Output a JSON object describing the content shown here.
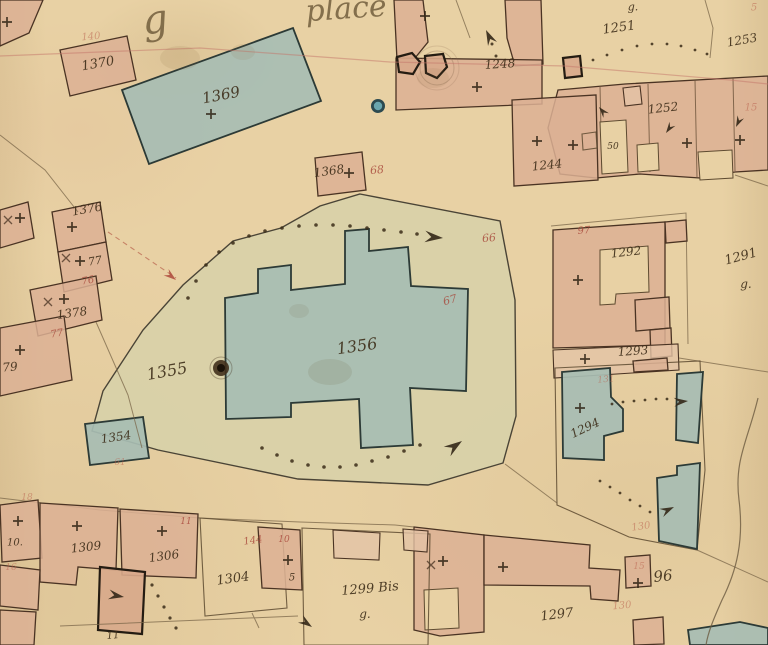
{
  "map": {
    "type": "historical-cadastral-map",
    "colors": {
      "paper": "#e8d1a4",
      "building_pink": "#dcb094",
      "building_blue": "#a7bdb3",
      "yard_green": "#d7d1a9",
      "ink": "#3a2a16",
      "red_ink": "#a8473a"
    },
    "labels": [
      {
        "n": "script-text-g",
        "t": "g",
        "x": 155,
        "y": 20,
        "s": 40,
        "r": -8,
        "c": "script"
      },
      {
        "n": "script-text-place",
        "t": "place",
        "x": 346,
        "y": 9,
        "s": 30,
        "r": -4,
        "c": "script"
      },
      {
        "n": "parcel-label-1370",
        "t": "1370",
        "x": 98,
        "y": 64,
        "s": 13,
        "r": -10,
        "c": "ink"
      },
      {
        "n": "parcel-label-1369",
        "t": "1369",
        "x": 221,
        "y": 95,
        "s": 15,
        "r": -11,
        "c": "ink"
      },
      {
        "n": "parcel-label-1368",
        "t": "1368",
        "x": 329,
        "y": 171,
        "s": 12,
        "r": -8,
        "c": "ink"
      },
      {
        "n": "parcel-label-1355",
        "t": "1355",
        "x": 167,
        "y": 371,
        "s": 16,
        "r": -10,
        "c": "ink"
      },
      {
        "n": "parcel-label-1356",
        "t": "1356",
        "x": 357,
        "y": 346,
        "s": 16,
        "r": -8,
        "c": "ink"
      },
      {
        "n": "parcel-label-1354",
        "t": "1354",
        "x": 116,
        "y": 437,
        "s": 12,
        "r": -8,
        "c": "ink"
      },
      {
        "n": "parcel-label-1376",
        "t": "1376",
        "x": 87,
        "y": 209,
        "s": 12,
        "r": -10,
        "c": "ink"
      },
      {
        "n": "parcel-label-77",
        "t": "77",
        "x": 95,
        "y": 261,
        "s": 11,
        "r": -10,
        "c": "ink"
      },
      {
        "n": "parcel-label-1378",
        "t": "1378",
        "x": 72,
        "y": 313,
        "s": 12,
        "r": -8,
        "c": "ink"
      },
      {
        "n": "parcel-label-79",
        "t": "79",
        "x": 10,
        "y": 367,
        "s": 12,
        "r": -5,
        "c": "ink"
      },
      {
        "n": "annotation-g-1251",
        "t": "g.",
        "x": 633,
        "y": 7,
        "s": 11,
        "r": 0,
        "c": "ink"
      },
      {
        "n": "parcel-label-1251",
        "t": "1251",
        "x": 619,
        "y": 28,
        "s": 13,
        "r": -8,
        "c": "ink"
      },
      {
        "n": "parcel-label-1253",
        "t": "1253",
        "x": 742,
        "y": 40,
        "s": 12,
        "r": -10,
        "c": "ink"
      },
      {
        "n": "parcel-label-1252",
        "t": "1252",
        "x": 663,
        "y": 108,
        "s": 12,
        "r": -6,
        "c": "ink"
      },
      {
        "n": "room-label-50",
        "t": "50",
        "x": 613,
        "y": 147,
        "s": 9,
        "r": 0,
        "c": "ink"
      },
      {
        "n": "parcel-label-1244",
        "t": "1244",
        "x": 547,
        "y": 165,
        "s": 12,
        "r": -6,
        "c": "ink"
      },
      {
        "n": "parcel-label-1248",
        "t": "1248",
        "x": 500,
        "y": 64,
        "s": 12,
        "r": -4,
        "c": "ink"
      },
      {
        "n": "parcel-label-1291",
        "t": "1291",
        "x": 741,
        "y": 257,
        "s": 13,
        "r": -15,
        "c": "ink"
      },
      {
        "n": "annotation-g-1291",
        "t": "g.",
        "x": 746,
        "y": 284,
        "s": 12,
        "r": 0,
        "c": "ink"
      },
      {
        "n": "parcel-label-1292",
        "t": "1292",
        "x": 626,
        "y": 252,
        "s": 12,
        "r": -6,
        "c": "ink"
      },
      {
        "n": "parcel-label-1293",
        "t": "1293",
        "x": 633,
        "y": 351,
        "s": 12,
        "r": -4,
        "c": "ink"
      },
      {
        "n": "parcel-label-1294",
        "t": "1294",
        "x": 585,
        "y": 428,
        "s": 12,
        "r": -25,
        "c": "ink"
      },
      {
        "n": "parcel-label-96",
        "t": "96",
        "x": 663,
        "y": 576,
        "s": 15,
        "r": -6,
        "c": "ink"
      },
      {
        "n": "parcel-label-1297",
        "t": "1297",
        "x": 557,
        "y": 615,
        "s": 13,
        "r": -7,
        "c": "ink"
      },
      {
        "n": "parcel-label-1299bis",
        "t": "1299 Bis",
        "x": 370,
        "y": 589,
        "s": 13,
        "r": -5,
        "c": "ink"
      },
      {
        "n": "annotation-g-1299",
        "t": "g.",
        "x": 365,
        "y": 614,
        "s": 12,
        "r": 0,
        "c": "ink"
      },
      {
        "n": "parcel-label-1304",
        "t": "1304",
        "x": 233,
        "y": 579,
        "s": 13,
        "r": -8,
        "c": "ink"
      },
      {
        "n": "parcel-label-1309",
        "t": "1309",
        "x": 86,
        "y": 547,
        "s": 12,
        "r": -6,
        "c": "ink"
      },
      {
        "n": "parcel-label-1306",
        "t": "1306",
        "x": 164,
        "y": 556,
        "s": 12,
        "r": -8,
        "c": "ink"
      },
      {
        "n": "parcel-label-10",
        "t": "10.",
        "x": 15,
        "y": 543,
        "s": 10,
        "r": 0,
        "c": "ink"
      },
      {
        "n": "parcel-label-5",
        "t": "5",
        "x": 292,
        "y": 578,
        "s": 10,
        "r": 0,
        "c": "ink"
      },
      {
        "n": "parcel-label-11",
        "t": "11",
        "x": 113,
        "y": 636,
        "s": 10,
        "r": -5,
        "c": "ink"
      },
      {
        "n": "red-ref-140",
        "t": "140",
        "x": 91,
        "y": 37,
        "s": 10,
        "r": -5,
        "c": "red-faded"
      },
      {
        "n": "red-ref-68",
        "t": "68",
        "x": 377,
        "y": 170,
        "s": 11,
        "r": -5,
        "c": "red"
      },
      {
        "n": "red-ref-66",
        "t": "66",
        "x": 489,
        "y": 238,
        "s": 11,
        "r": -5,
        "c": "red"
      },
      {
        "n": "red-ref-67",
        "t": "67",
        "x": 450,
        "y": 300,
        "s": 11,
        "r": -15,
        "c": "red"
      },
      {
        "n": "red-ref-76",
        "t": "76",
        "x": 88,
        "y": 281,
        "s": 10,
        "r": -10,
        "c": "red"
      },
      {
        "n": "red-ref-77",
        "t": "77",
        "x": 57,
        "y": 334,
        "s": 10,
        "r": -10,
        "c": "red"
      },
      {
        "n": "red-ref-97",
        "t": "97",
        "x": 584,
        "y": 231,
        "s": 10,
        "r": -5,
        "c": "red"
      },
      {
        "n": "red-ref-5",
        "t": "5",
        "x": 754,
        "y": 8,
        "s": 10,
        "r": 0,
        "c": "red-faded"
      },
      {
        "n": "red-ref-15a",
        "t": "15",
        "x": 751,
        "y": 108,
        "s": 10,
        "r": 0,
        "c": "red-faded"
      },
      {
        "n": "red-ref-11",
        "t": "11",
        "x": 186,
        "y": 522,
        "s": 9,
        "r": 0,
        "c": "red"
      },
      {
        "n": "red-ref-10",
        "t": "10",
        "x": 284,
        "y": 540,
        "s": 9,
        "r": 0,
        "c": "red"
      },
      {
        "n": "red-ref-144",
        "t": "144",
        "x": 253,
        "y": 541,
        "s": 10,
        "r": -8,
        "c": "red"
      },
      {
        "n": "red-ref-18",
        "t": "18",
        "x": 27,
        "y": 498,
        "s": 9,
        "r": 0,
        "c": "red-faded"
      },
      {
        "n": "red-ref-16",
        "t": "16",
        "x": 11,
        "y": 568,
        "s": 9,
        "r": 0,
        "c": "red-faded"
      },
      {
        "n": "red-ref-131",
        "t": "131",
        "x": 606,
        "y": 380,
        "s": 9,
        "r": -5,
        "c": "red-faded"
      },
      {
        "n": "red-ref-130a",
        "t": "130",
        "x": 641,
        "y": 527,
        "s": 10,
        "r": -8,
        "c": "red-faded"
      },
      {
        "n": "red-ref-130b",
        "t": "130",
        "x": 622,
        "y": 606,
        "s": 10,
        "r": -5,
        "c": "red-faded"
      },
      {
        "n": "red-ref-15b",
        "t": "15",
        "x": 639,
        "y": 567,
        "s": 9,
        "r": 0,
        "c": "red-faded"
      },
      {
        "n": "red-ref-61",
        "t": "61",
        "x": 120,
        "y": 463,
        "s": 9,
        "r": 0,
        "c": "red-faded"
      }
    ],
    "markers": {
      "crosses": [
        [
          7,
          22
        ],
        [
          425,
          16
        ],
        [
          477,
          87
        ],
        [
          537,
          141
        ],
        [
          573,
          145
        ],
        [
          687,
          143
        ],
        [
          740,
          140
        ],
        [
          72,
          227
        ],
        [
          80,
          261
        ],
        [
          64,
          299
        ],
        [
          20,
          350
        ],
        [
          20,
          218
        ],
        [
          211,
          114
        ],
        [
          349,
          173
        ],
        [
          578,
          280
        ],
        [
          585,
          359
        ],
        [
          580,
          408
        ],
        [
          443,
          561
        ],
        [
          503,
          567
        ],
        [
          638,
          583
        ],
        [
          18,
          521
        ],
        [
          77,
          526
        ],
        [
          162,
          531
        ],
        [
          288,
          560
        ]
      ],
      "x_marks": [
        [
          66,
          258
        ],
        [
          48,
          302
        ],
        [
          8,
          220
        ],
        [
          431,
          565
        ]
      ],
      "arrows": [
        {
          "x": 443,
          "y": 238,
          "angle": 5,
          "size": 1.3,
          "color": "ink"
        },
        {
          "x": 462,
          "y": 441,
          "angle": -35,
          "size": 1.3,
          "color": "ink"
        },
        {
          "x": 486,
          "y": 30,
          "angle": -115,
          "size": 1.1,
          "color": "ink"
        },
        {
          "x": 688,
          "y": 401,
          "angle": -5,
          "size": 1.0,
          "color": "ink"
        },
        {
          "x": 674,
          "y": 507,
          "angle": -25,
          "size": 1.0,
          "color": "ink"
        },
        {
          "x": 124,
          "y": 597,
          "angle": 10,
          "size": 1.1,
          "color": "ink"
        },
        {
          "x": 312,
          "y": 627,
          "angle": 35,
          "size": 1.0,
          "color": "ink"
        },
        {
          "x": 599,
          "y": 107,
          "angle": -130,
          "size": 0.8,
          "color": "ink"
        },
        {
          "x": 666,
          "y": 133,
          "angle": 125,
          "size": 0.8,
          "color": "ink"
        },
        {
          "x": 736,
          "y": 127,
          "angle": 115,
          "size": 0.8,
          "color": "ink"
        },
        {
          "x": 176,
          "y": 280,
          "angle": 38,
          "size": 0.9,
          "color": "red"
        }
      ],
      "dot_paths": [
        {
          "r": 1.8,
          "pts": [
            [
              188,
              298
            ],
            [
              196,
              281
            ],
            [
              206,
              265
            ],
            [
              219,
              252
            ],
            [
              233,
              243
            ],
            [
              249,
              236
            ],
            [
              265,
              231
            ],
            [
              282,
              228
            ],
            [
              299,
              226
            ],
            [
              316,
              225
            ],
            [
              333,
              225
            ],
            [
              350,
              226
            ],
            [
              367,
              228
            ],
            [
              384,
              230
            ],
            [
              401,
              232
            ],
            [
              417,
              234
            ]
          ]
        },
        {
          "r": 1.8,
          "pts": [
            [
              262,
              448
            ],
            [
              277,
              455
            ],
            [
              292,
              461
            ],
            [
              308,
              465
            ],
            [
              324,
              467
            ],
            [
              340,
              467
            ],
            [
              356,
              465
            ],
            [
              372,
              461
            ],
            [
              388,
              457
            ],
            [
              404,
              451
            ],
            [
              420,
              445
            ]
          ]
        },
        {
          "r": 1.4,
          "pts": [
            [
              593,
              60
            ],
            [
              607,
              55
            ],
            [
              622,
              50
            ],
            [
              637,
              46
            ],
            [
              652,
              44
            ],
            [
              667,
              44
            ],
            [
              681,
              46
            ],
            [
              695,
              50
            ],
            [
              707,
              54
            ]
          ]
        },
        {
          "r": 1.4,
          "pts": [
            [
              612,
              404
            ],
            [
              623,
              402
            ],
            [
              634,
              401
            ],
            [
              645,
              400
            ],
            [
              656,
              399
            ],
            [
              667,
              399
            ]
          ]
        },
        {
          "r": 1.4,
          "pts": [
            [
              600,
              481
            ],
            [
              610,
              487
            ],
            [
              620,
              493
            ],
            [
              630,
              500
            ],
            [
              640,
              506
            ],
            [
              650,
              512
            ]
          ]
        },
        {
          "r": 1.6,
          "pts": [
            [
              152,
              585
            ],
            [
              158,
              596
            ],
            [
              164,
              607
            ],
            [
              170,
              618
            ],
            [
              176,
              628
            ]
          ]
        },
        {
          "r": 1.5,
          "pts": [
            [
              492,
              44
            ],
            [
              496,
              56
            ]
          ]
        }
      ]
    }
  }
}
